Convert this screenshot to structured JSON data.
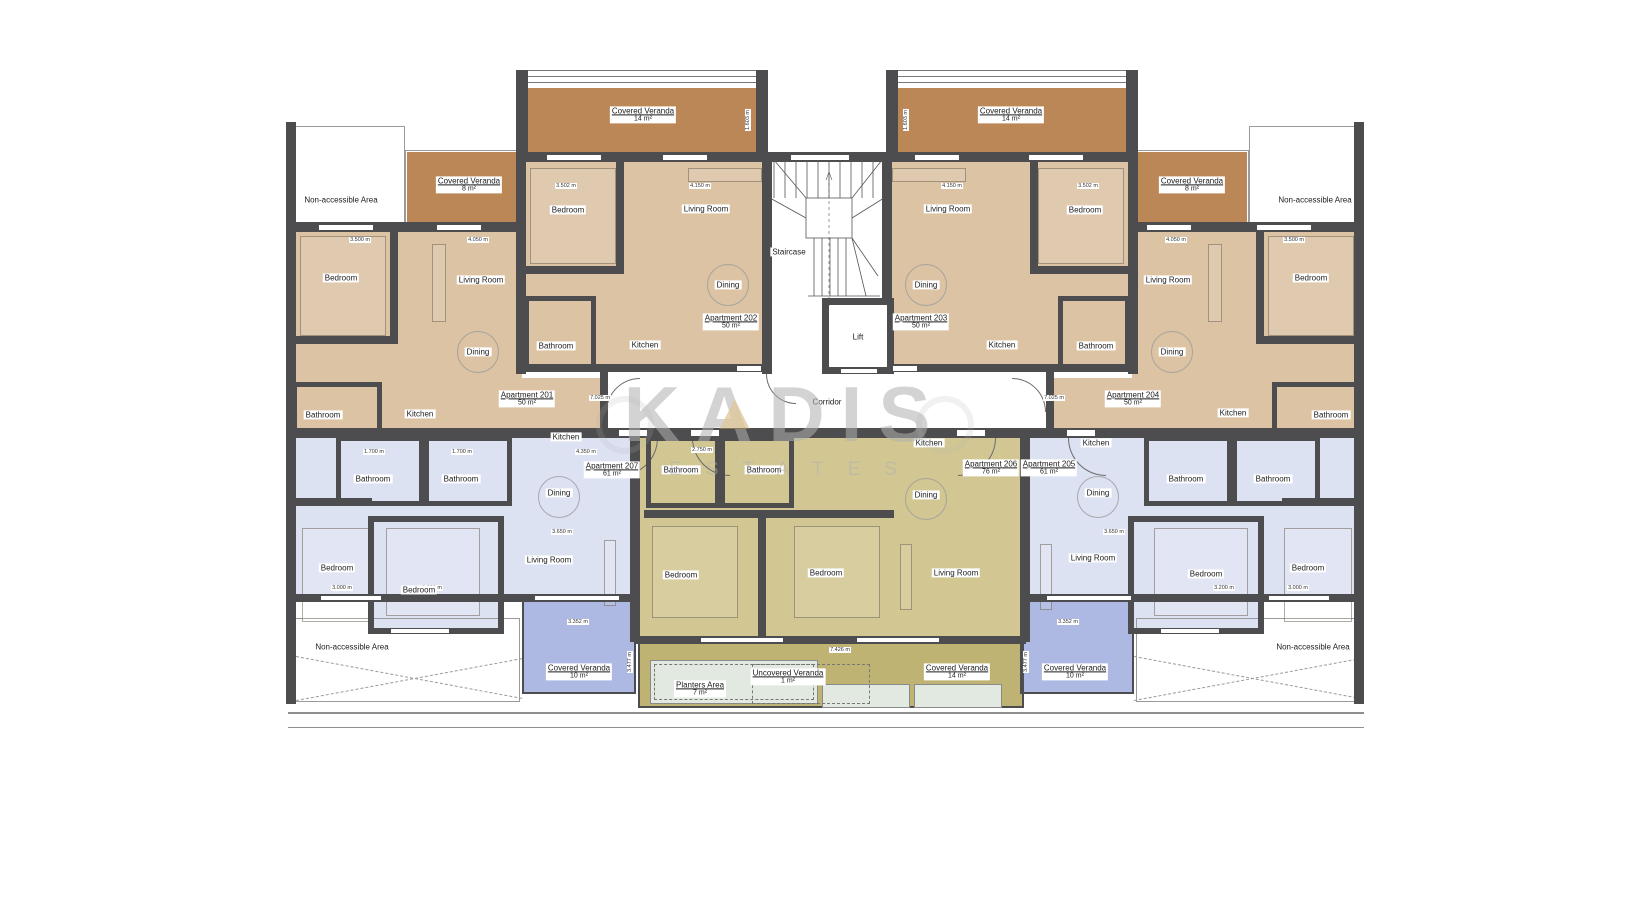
{
  "watermark": {
    "brand": "KADIS",
    "sub": "ESTATES"
  },
  "colors": {
    "wall": "#4d4d4f",
    "tan_room": "#dcc3a4",
    "tan_veranda": "#bc8756",
    "blue_room": "#dde2f3",
    "blue_veranda": "#adb9e3",
    "olive_room": "#d2c792",
    "olive_veranda": "#bfb374",
    "planter": "#e2e9e0",
    "watermark_grey": "#b0b0b0",
    "watermark_gold": "#c69b4e"
  },
  "plan": {
    "labels": [
      {
        "n": "veranda-label-top-left-14",
        "t": "Covered Veranda",
        "s": "14 m²",
        "u": true,
        "x": 643,
        "y": 115
      },
      {
        "n": "veranda-label-top-right-14",
        "t": "Covered Veranda",
        "s": "14 m²",
        "u": true,
        "x": 1011,
        "y": 115
      },
      {
        "n": "veranda-label-left-8",
        "t": "Covered Veranda",
        "s": "8 m²",
        "u": true,
        "x": 469,
        "y": 185
      },
      {
        "n": "veranda-label-right-8",
        "t": "Covered Veranda",
        "s": "8 m²",
        "u": true,
        "x": 1192,
        "y": 185
      },
      {
        "n": "non-accessible-top-left",
        "t": "Non-accessible Area",
        "x": 341,
        "y": 200
      },
      {
        "n": "non-accessible-top-right",
        "t": "Non-accessible Area",
        "x": 1315,
        "y": 200
      },
      {
        "n": "apt201-bedroom",
        "t": "Bedroom",
        "x": 341,
        "y": 278
      },
      {
        "n": "apt201-living-room",
        "t": "Living Room",
        "x": 481,
        "y": 280
      },
      {
        "n": "apt201-dining",
        "t": "Dining",
        "x": 478,
        "y": 352
      },
      {
        "n": "apt201-bathroom",
        "t": "Bathroom",
        "x": 323,
        "y": 415
      },
      {
        "n": "apt201-kitchen",
        "t": "Kitchen",
        "x": 420,
        "y": 414
      },
      {
        "n": "apt201-label",
        "t": "Apartment 201",
        "s": "50 m²",
        "u": true,
        "x": 527,
        "y": 399
      },
      {
        "n": "apt202-bedroom",
        "t": "Bedroom",
        "x": 568,
        "y": 210
      },
      {
        "n": "apt202-living-room",
        "t": "Living Room",
        "x": 706,
        "y": 209
      },
      {
        "n": "apt202-dining",
        "t": "Dining",
        "x": 728,
        "y": 285
      },
      {
        "n": "apt202-bathroom",
        "t": "Bathroom",
        "x": 556,
        "y": 346
      },
      {
        "n": "apt202-kitchen",
        "t": "Kitchen",
        "x": 645,
        "y": 345
      },
      {
        "n": "apt202-label",
        "t": "Apartment 202",
        "s": "50 m²",
        "u": true,
        "x": 731,
        "y": 322
      },
      {
        "n": "staircase-label",
        "t": "Staircase",
        "x": 789,
        "y": 252
      },
      {
        "n": "lift-label",
        "t": "Lift",
        "x": 858,
        "y": 337
      },
      {
        "n": "corridor-label",
        "t": "Corridor",
        "x": 827,
        "y": 402
      },
      {
        "n": "apt203-living-room",
        "t": "Living Room",
        "x": 948,
        "y": 209
      },
      {
        "n": "apt203-bedroom",
        "t": "Bedroom",
        "x": 1085,
        "y": 210
      },
      {
        "n": "apt203-dining",
        "t": "Dining",
        "x": 926,
        "y": 285
      },
      {
        "n": "apt203-kitchen",
        "t": "Kitchen",
        "x": 1002,
        "y": 345
      },
      {
        "n": "apt203-bathroom",
        "t": "Bathroom",
        "x": 1096,
        "y": 346
      },
      {
        "n": "apt203-label",
        "t": "Apartment 203",
        "s": "50 m²",
        "u": true,
        "x": 921,
        "y": 322
      },
      {
        "n": "apt204-living-room",
        "t": "Living Room",
        "x": 1168,
        "y": 280
      },
      {
        "n": "apt204-bedroom",
        "t": "Bedroom",
        "x": 1311,
        "y": 278
      },
      {
        "n": "apt204-dining",
        "t": "Dining",
        "x": 1172,
        "y": 352
      },
      {
        "n": "apt204-kitchen",
        "t": "Kitchen",
        "x": 1233,
        "y": 413
      },
      {
        "n": "apt204-bathroom",
        "t": "Bathroom",
        "x": 1331,
        "y": 415
      },
      {
        "n": "apt204-label",
        "t": "Apartment 204",
        "s": "50 m²",
        "u": true,
        "x": 1133,
        "y": 399
      },
      {
        "n": "apt207-bathroom-1",
        "t": "Bathroom",
        "x": 373,
        "y": 479
      },
      {
        "n": "apt207-bathroom-2",
        "t": "Bathroom",
        "x": 461,
        "y": 479
      },
      {
        "n": "apt207-kitchen",
        "t": "Kitchen",
        "x": 566,
        "y": 437
      },
      {
        "n": "apt207-label",
        "t": "Apartment 207",
        "s": "61 m²",
        "u": true,
        "x": 612,
        "y": 470
      },
      {
        "n": "apt207-dining",
        "t": "Dining",
        "x": 559,
        "y": 493
      },
      {
        "n": "apt207-bedroom-1",
        "t": "Bedroom",
        "x": 337,
        "y": 568
      },
      {
        "n": "apt207-bedroom-2",
        "t": "Bedroom",
        "x": 419,
        "y": 590
      },
      {
        "n": "apt207-living-room",
        "t": "Living Room",
        "x": 549,
        "y": 560
      },
      {
        "n": "apt206-bathroom-1",
        "t": "Bathroom",
        "x": 681,
        "y": 470
      },
      {
        "n": "apt206-bathroom-2",
        "t": "Bathroom",
        "x": 764,
        "y": 470
      },
      {
        "n": "apt206-kitchen",
        "t": "Kitchen",
        "x": 929,
        "y": 443
      },
      {
        "n": "apt206-dining",
        "t": "Dining",
        "x": 926,
        "y": 495
      },
      {
        "n": "apt206-label",
        "t": "Apartment 206",
        "s": "76 m²",
        "u": true,
        "x": 991,
        "y": 468
      },
      {
        "n": "apt206-bedroom-1",
        "t": "Bedroom",
        "x": 681,
        "y": 575
      },
      {
        "n": "apt206-bedroom-2",
        "t": "Bedroom",
        "x": 826,
        "y": 573
      },
      {
        "n": "apt206-living-room",
        "t": "Living Room",
        "x": 956,
        "y": 573
      },
      {
        "n": "apt205-label",
        "t": "Apartment 205",
        "s": "61 m²",
        "u": true,
        "x": 1049,
        "y": 468
      },
      {
        "n": "apt205-kitchen",
        "t": "Kitchen",
        "x": 1096,
        "y": 443
      },
      {
        "n": "apt205-dining",
        "t": "Dining",
        "x": 1098,
        "y": 493
      },
      {
        "n": "apt205-living-room",
        "t": "Living Room",
        "x": 1093,
        "y": 558
      },
      {
        "n": "apt205-bathroom-1",
        "t": "Bathroom",
        "x": 1186,
        "y": 479
      },
      {
        "n": "apt205-bathroom-2",
        "t": "Bathroom",
        "x": 1273,
        "y": 479
      },
      {
        "n": "apt205-bedroom-1",
        "t": "Bedroom",
        "x": 1206,
        "y": 574
      },
      {
        "n": "apt205-bedroom-2",
        "t": "Bedroom",
        "x": 1308,
        "y": 568
      },
      {
        "n": "non-accessible-bottom-left",
        "t": "Non-accessible Area",
        "x": 352,
        "y": 647
      },
      {
        "n": "non-accessible-bottom-right",
        "t": "Non-accessible Area",
        "x": 1313,
        "y": 647
      },
      {
        "n": "veranda-label-bottom-left-10",
        "t": "Covered Veranda",
        "s": "10 m²",
        "u": true,
        "x": 579,
        "y": 672
      },
      {
        "n": "veranda-label-bottom-right-10",
        "t": "Covered Veranda",
        "s": "10 m²",
        "u": true,
        "x": 1075,
        "y": 672
      },
      {
        "n": "veranda-label-bottom-14",
        "t": "Covered Veranda",
        "s": "14 m²",
        "u": true,
        "x": 957,
        "y": 672
      },
      {
        "n": "uncovered-veranda-label",
        "t": "Uncovered Veranda",
        "s": "1 m²",
        "u": true,
        "x": 788,
        "y": 677
      },
      {
        "n": "planters-area-label",
        "t": "Planters Area",
        "s": "7 m²",
        "u": true,
        "x": 700,
        "y": 689
      }
    ],
    "dimensions": [
      {
        "t": "3.500 m",
        "x": 360,
        "y": 240
      },
      {
        "t": "4.050 m",
        "x": 478,
        "y": 240
      },
      {
        "t": "3.502 m",
        "x": 566,
        "y": 186
      },
      {
        "t": "4.150 m",
        "x": 700,
        "y": 186
      },
      {
        "t": "4.150 m",
        "x": 952,
        "y": 186
      },
      {
        "t": "3.502 m",
        "x": 1088,
        "y": 186
      },
      {
        "t": "4.050 m",
        "x": 1176,
        "y": 240
      },
      {
        "t": "3.500 m",
        "x": 1294,
        "y": 240
      },
      {
        "t": "1.603 m",
        "x": 748,
        "y": 120,
        "v": true
      },
      {
        "t": "1.603 m",
        "x": 906,
        "y": 120,
        "v": true
      },
      {
        "t": "7.025 m",
        "x": 600,
        "y": 398
      },
      {
        "t": "7.025 m",
        "x": 1054,
        "y": 398
      },
      {
        "t": "1.700 m",
        "x": 374,
        "y": 452
      },
      {
        "t": "1.700 m",
        "x": 462,
        "y": 452
      },
      {
        "t": "4.350 m",
        "x": 586,
        "y": 452
      },
      {
        "t": "2.750 m",
        "x": 702,
        "y": 450
      },
      {
        "t": "3.650 m",
        "x": 562,
        "y": 532
      },
      {
        "t": "3.000 m",
        "x": 342,
        "y": 588
      },
      {
        "t": "3.200 m",
        "x": 432,
        "y": 588
      },
      {
        "t": "3.650 m",
        "x": 1114,
        "y": 532
      },
      {
        "t": "3.200 m",
        "x": 1224,
        "y": 588
      },
      {
        "t": "3.000 m",
        "x": 1298,
        "y": 588
      },
      {
        "t": "3.352 m",
        "x": 578,
        "y": 622
      },
      {
        "t": "3.352 m",
        "x": 1068,
        "y": 622
      },
      {
        "t": "7.426 m",
        "x": 840,
        "y": 650
      },
      {
        "t": "3.477 m",
        "x": 630,
        "y": 662,
        "v": true
      },
      {
        "t": "3.477 m",
        "x": 1026,
        "y": 662,
        "v": true
      }
    ]
  }
}
